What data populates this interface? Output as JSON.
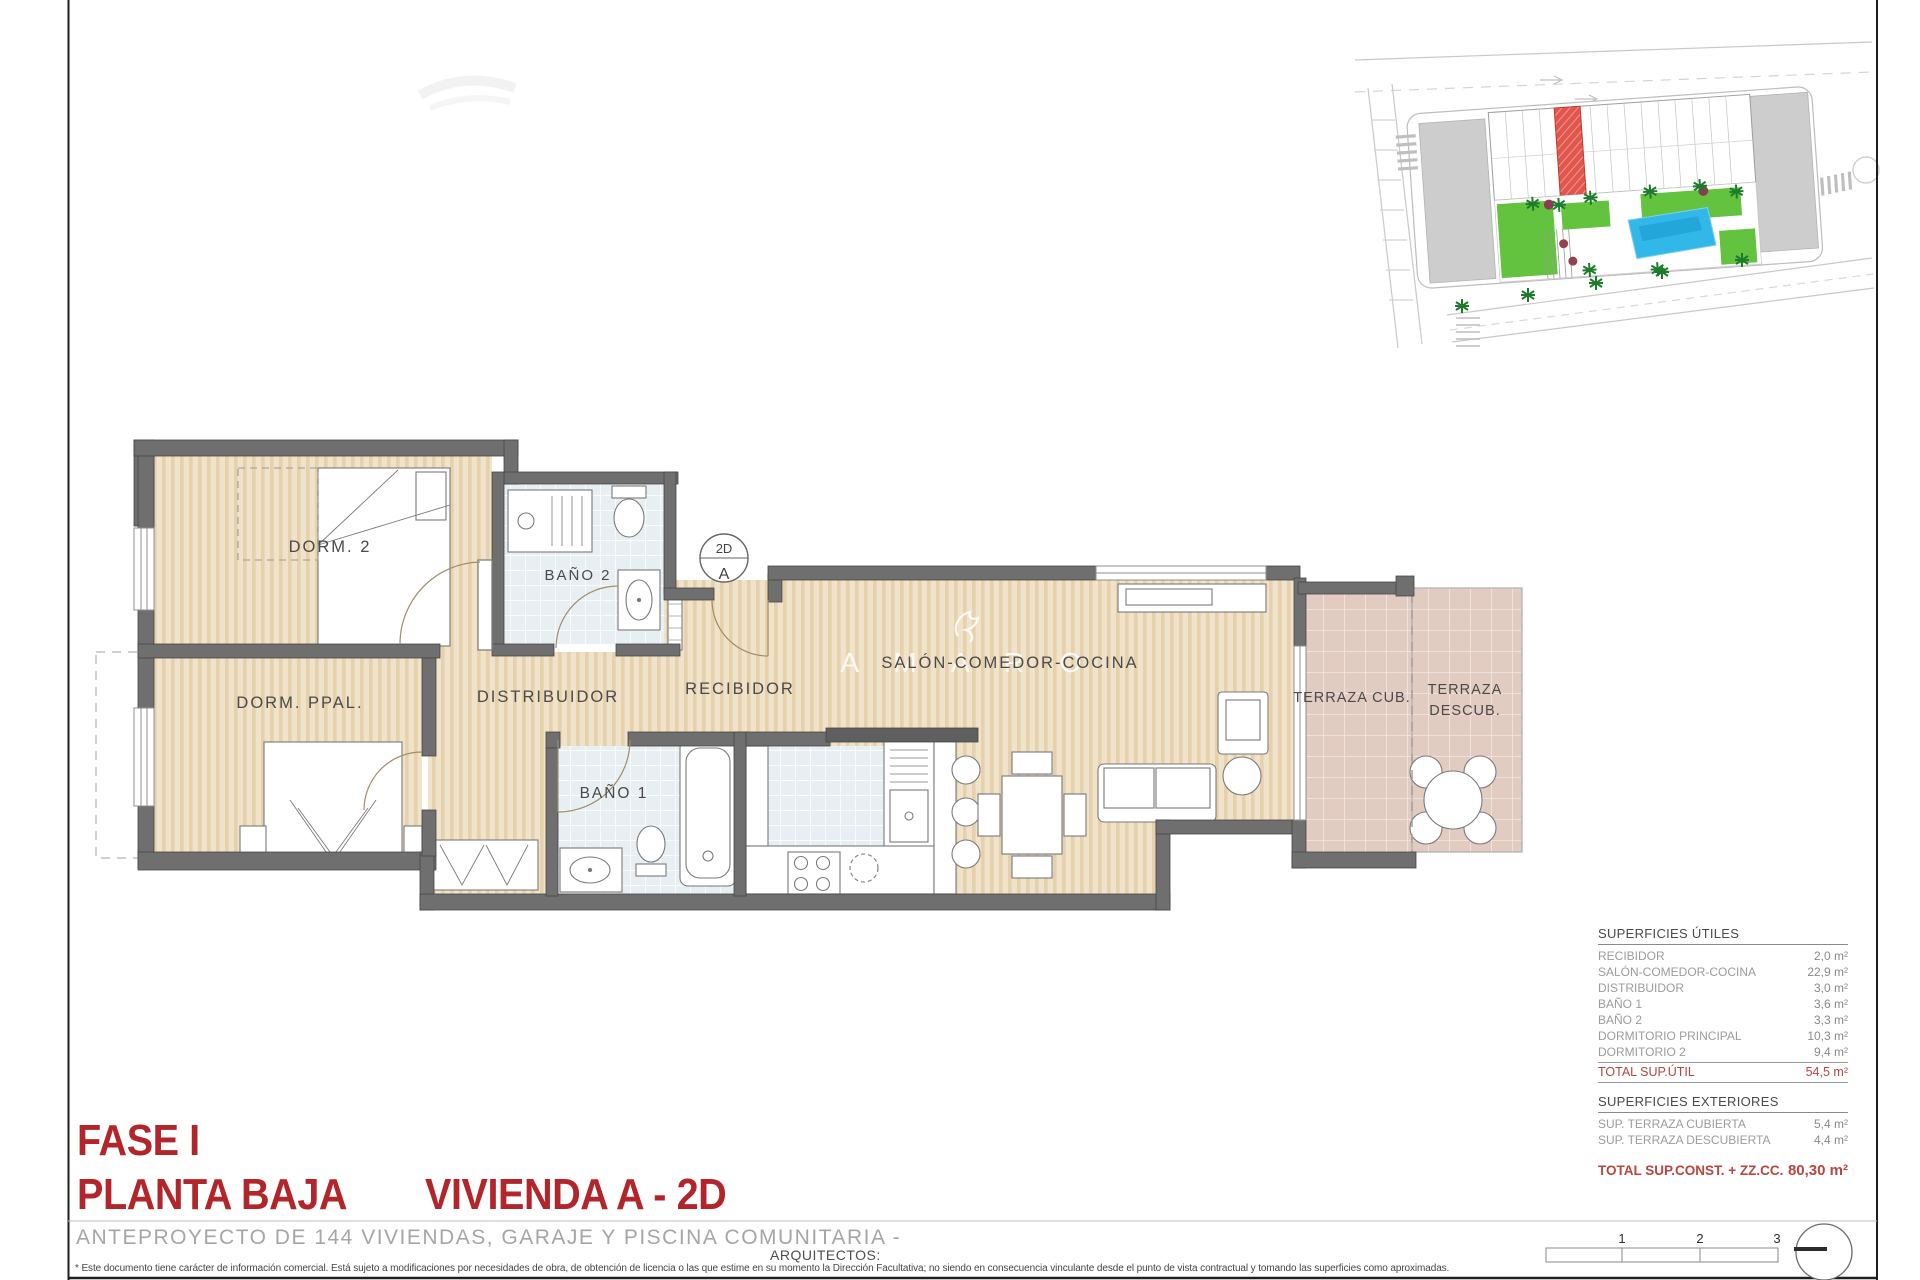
{
  "colors": {
    "accent_red": "#b2262b",
    "total_red": "#b8453f",
    "wall_gray": "#6f6f6f",
    "wood_floor": "#f0e3c9",
    "bath_tile": "#e8eff3",
    "terrace_tile": "#e2cbc0",
    "site_highlight": "#e2574d",
    "site_pool": "#31b7e8",
    "site_green": "#63c23e"
  },
  "plan": {
    "watermark": "A M A R O",
    "marker": {
      "top": "2D",
      "bottom": "A"
    },
    "rooms": {
      "dorm2": "DORM. 2",
      "bano2": "BAÑO 2",
      "dorm_ppal": "DORM. PPAL.",
      "distribuidor": "DISTRIBUIDOR",
      "recibidor": "RECIBIDOR",
      "bano1": "BAÑO 1",
      "salon": "SALÓN-COMEDOR-COCINA",
      "terraza_cub": "TERRAZA CUB.",
      "terraza_descub_line1": "TERRAZA",
      "terraza_descub_line2": "DESCUB."
    }
  },
  "tables": {
    "utiles": {
      "title": "SUPERFICIES ÚTILES",
      "rows": [
        {
          "label": "RECIBIDOR",
          "value": "2,0 m²"
        },
        {
          "label": "SALÓN-COMEDOR-COCINA",
          "value": "22,9 m²"
        },
        {
          "label": "DISTRIBUIDOR",
          "value": "3,0 m²"
        },
        {
          "label": "BAÑO 1",
          "value": "3,6 m²"
        },
        {
          "label": "BAÑO 2",
          "value": "3,3 m²"
        },
        {
          "label": "DORMITORIO PRINCIPAL",
          "value": "10,3 m²"
        },
        {
          "label": "DORMITORIO 2",
          "value": "9,4 m²"
        }
      ],
      "total_label": "TOTAL SUP.ÚTIL",
      "total_value": "54,5 m²"
    },
    "exteriores": {
      "title": "SUPERFICIES EXTERIORES",
      "rows": [
        {
          "label": "SUP. TERRAZA CUBIERTA",
          "value": "5,4 m²"
        },
        {
          "label": "SUP. TERRAZA DESCUBIERTA",
          "value": "4,4 m²"
        }
      ],
      "total_label": "TOTAL SUP.CONST. + ZZ.CC.",
      "total_value": "80,30 m²"
    }
  },
  "title_block": {
    "phase": "FASE I",
    "floor": "PLANTA BAJA",
    "unit": "VIVIENDA A - 2D",
    "subtitle": "ANTEPROYECTO DE 144 VIVIENDAS, GARAJE Y PISCINA COMUNITARIA -",
    "architects_label": "ARQUITECTOS:",
    "disclaimer": "* Este documento tiene carácter de información comercial. Está sujeto a modificaciones por necesidades de obra, de obtención de licencia o las que estime en su momento la Dirección Facultativa; no siendo en consecuencia vinculante desde el punto de vista contractual y tomando las superficies como aproximadas."
  },
  "scale_bar": {
    "ticks": [
      "1",
      "2",
      "3"
    ]
  }
}
